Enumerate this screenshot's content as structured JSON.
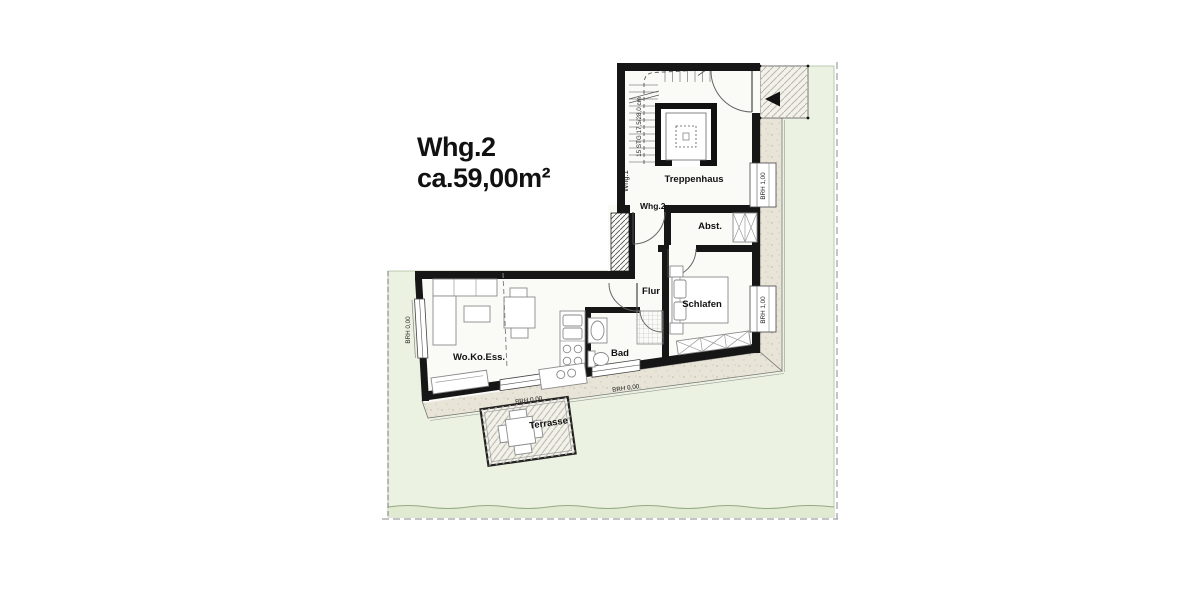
{
  "plan": {
    "title": {
      "line1": "Whg.2",
      "line2": "ca.59,00m²"
    },
    "rooms": {
      "treppenhaus": "Treppenhaus",
      "abstellraum": "Abst.",
      "flur": "Flur",
      "schlafen": "Schlafen",
      "bad": "Bad",
      "wohnen_kochen_essen": "Wo.Ko.Ess.",
      "terrasse": "Terrasse"
    },
    "annotations": {
      "unit1": "Whg.1",
      "unit2_entry": "Whg.2",
      "stairs_note": "15 STG 17,5/28,0 cm",
      "brh_west": "BRH 0,00",
      "brh_south_terrace": "BRH 0,00",
      "brh_south_bad": "BRH 0,00",
      "brh_east_treppenhaus": "BRH 1,00",
      "brh_east_schlafen": "BRH 1,00"
    },
    "colors": {
      "site_green": "#ecf2e2",
      "site_green_dark": "#e0ead0",
      "walkway": "#e8e5d8",
      "paving": "#f2f1ea",
      "wall": "#161616",
      "floor": "#fafaf7"
    }
  }
}
